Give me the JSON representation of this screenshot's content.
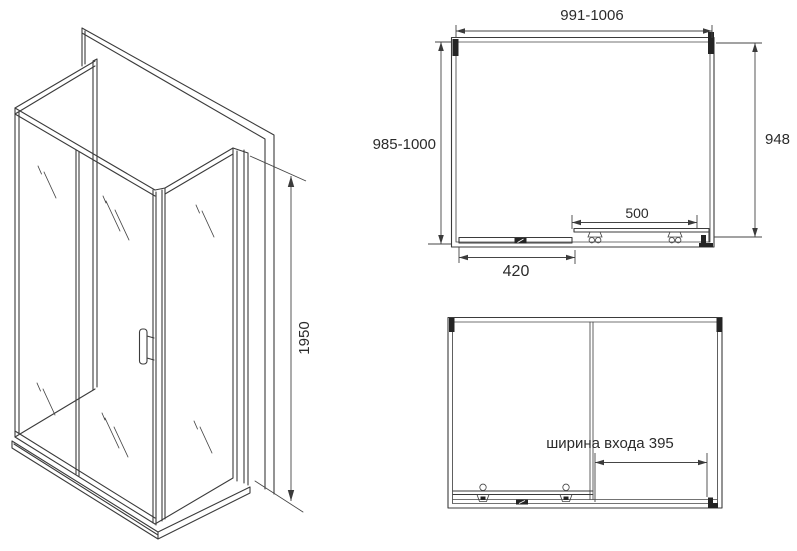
{
  "colors": {
    "line": "#3b3b3b",
    "text": "#2b2b2b",
    "black_marks": "#242424",
    "background": "#ffffff"
  },
  "iso_view": {
    "height_dim": "1950"
  },
  "top_view": {
    "width_dim": "991-1006",
    "depth_dim": "985-1000",
    "side_dim": "948",
    "door_dim": "500",
    "fixed_panel_dim": "420"
  },
  "front_view": {
    "entrance_dim": "ширина входа 395"
  }
}
